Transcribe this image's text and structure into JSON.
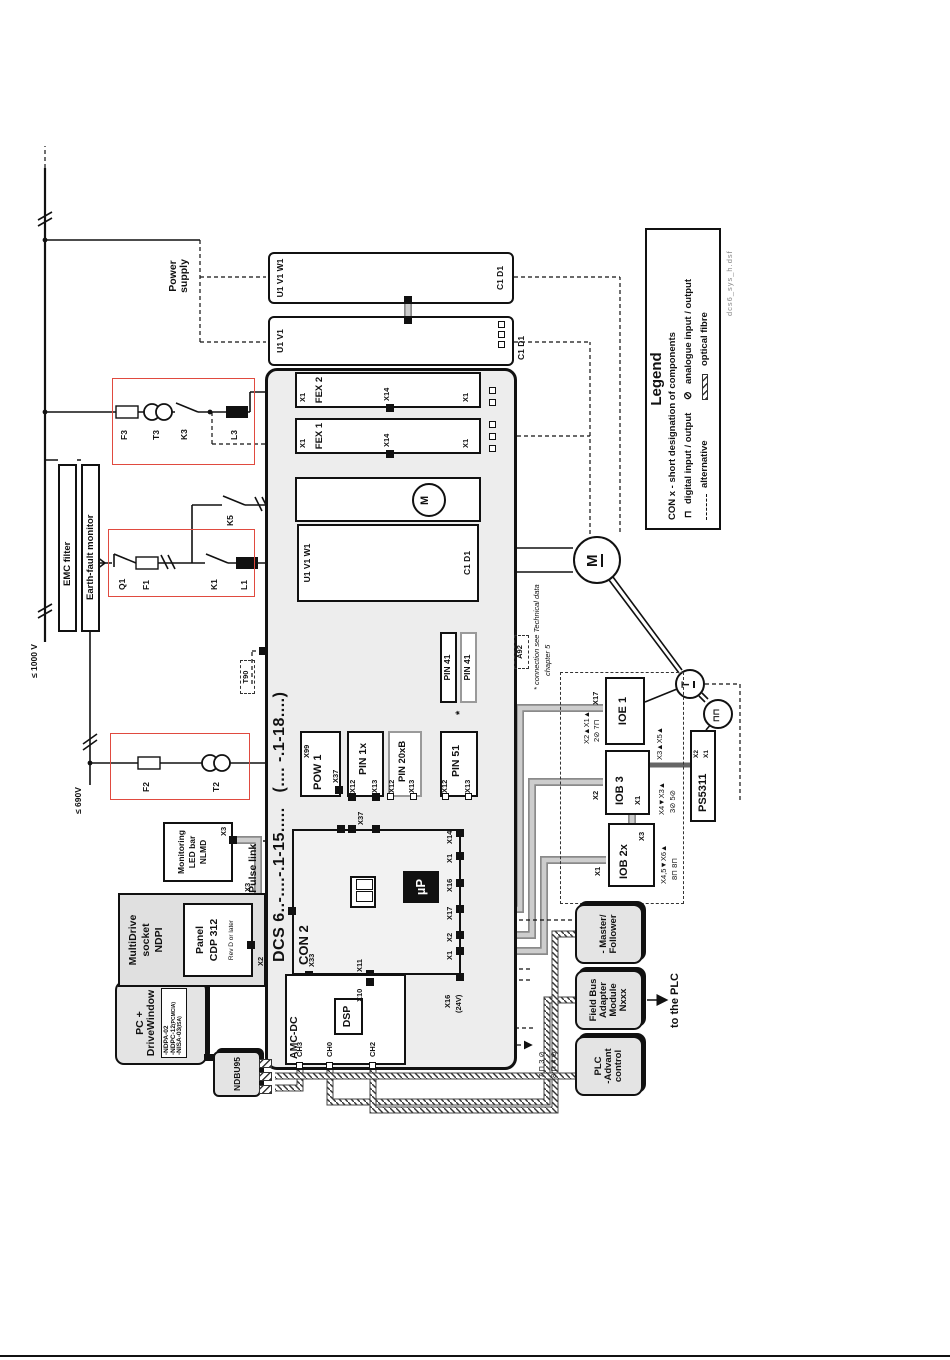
{
  "page": {
    "file": "dcs6_sys_h.dsf"
  },
  "power": {
    "supply": "Power supply",
    "v1000": "≤ 1000 V",
    "v690": "≤ 690V",
    "emc": "EMC filter",
    "efm": "Earth-fault monitor",
    "q1": "Q1",
    "f1": "F1",
    "k1": "K1",
    "l1": "L1",
    "k5": "K5",
    "f3": "F3",
    "t3": "T3",
    "k3": "K3",
    "l3": "L3",
    "f2": "F2",
    "t2": "T2"
  },
  "ext": {
    "u1v1w1": "U1 V1 W1",
    "u1v1": "U1 V1",
    "c1d1": "C1 D1"
  },
  "drive": {
    "model": "DCS 6..-....-.1-15.....",
    "model2": "(....  -.1-18....)",
    "fex1": "FEX 1",
    "fex2": "FEX 2",
    "pow1": "POW 1",
    "pin1x": "PIN 1x",
    "pin20xb": "PIN 20xB",
    "pin51": "PIN 51",
    "pin41": "PIN 41",
    "star": "*",
    "con2": "CON 2",
    "up": "µP",
    "amc": "AMC-DC",
    "dsp": "DSP",
    "ch0": "CH0",
    "ch2": "CH2",
    "ch3": "CH3",
    "pulse_link": "12-Pulse link",
    "x16_24": "X16",
    "v24": "(24V)",
    "t90": "T90",
    "a92": "A92",
    "note1": "* connection see Technical data",
    "note2": "chapter 5"
  },
  "conn": {
    "x1": "X1",
    "x2": "X2",
    "x3": "X3",
    "x10": "X10",
    "x11": "X11",
    "x12": "X12",
    "x13": "X13",
    "x14": "X14",
    "x16": "X16",
    "x17": "X17",
    "x33": "X33",
    "x37": "X37",
    "x99": "X99"
  },
  "io": {
    "ioe1": "IOE 1",
    "iob3": "IOB 3",
    "iob2x": "IOB 2x",
    "ps5311": "PS5311",
    "ps_x2": "X2",
    "ps_x1": "X1",
    "ioe1_io": "X2▲X1▲",
    "ioe1_sig": "2⊘ 7⊓",
    "iob3_io": "X4▼X3▲",
    "iob3_sig": "3⊘ 5⊘",
    "iob3_ps": "X3▲X5▲",
    "iob2x_io": "X4,5▼X6▲",
    "iob2x_sig": "8⊓ 8⊓",
    "out_sig": "7 ⊓   3 ⊘",
    "in_sig": "8 ⊓   4 ⊘",
    "motor": "M",
    "fan_motor": "M",
    "tacho": "T",
    "encoder": "⊓⊓"
  },
  "tools": {
    "pc1": "PC +",
    "pc2": "DriveWindow",
    "ndpa": "-NDPA-02",
    "ndpc": "-NDPC-12",
    "pcmcia": "(PCMCIA)",
    "nisa": "-NISA-03",
    "isa": "(ISA)",
    "ndbu": "NDBU95",
    "md1": "MultiDrive",
    "md2": "socket",
    "md3": "NDPI",
    "panel": "Panel",
    "cdp": "CDP 312",
    "rev": "Rev D or later",
    "mon1": "Monitoring",
    "mon2": "LED bar",
    "mon3": "NLMD"
  },
  "plc": {
    "mf1": "- Master/",
    "mf2": "Follower",
    "fb1": "Field Bus",
    "fb2": "Adapter",
    "fb3": "Module",
    "fb4": "Nxxx",
    "p1": "PLC",
    "p2": "-Advant",
    "p3": "control",
    "to_plc": "to the PLC"
  },
  "legend": {
    "title": "Legend",
    "desc": "CON x - short designation of components",
    "digital": "digital input / output",
    "analogue": "analogue input / output",
    "alt": "alternative",
    "fibre": "optical fibre",
    "dsym": "⊓",
    "asym": "⊘"
  },
  "colors": {
    "red_frame": "#e04a3f",
    "ribbon": "#c8c8c8",
    "module_fill": "#ededed",
    "shadow_fill": "#e4e4e4"
  }
}
